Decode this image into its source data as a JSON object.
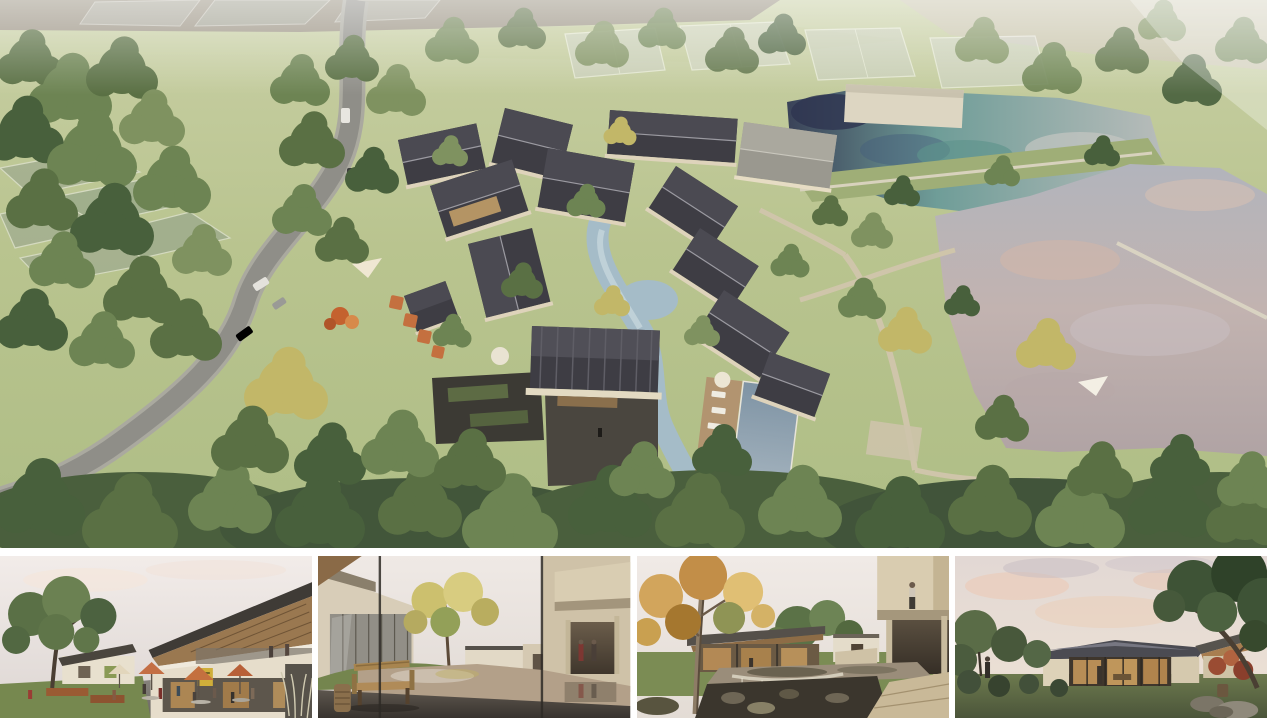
{
  "page": {
    "background": "#ffffff"
  },
  "panels": {
    "aerial": {
      "label": "Aerial rendering of a village resort masterplan: pitched-roof houses along a winding stream, curving road with cars on the left, dense woodland, lap pool with sun deck, and two reflective lakes on the right"
    },
    "street": {
      "label": "Street-level rendering of a retail lane with cafe seating, orange umbrellas, a large tree and a two-storey timber-roofed building"
    },
    "courtyard_pond": {
      "label": "Rendering of a courtyard reflecting pond seen through a window, with a wooden slat bench, yellow tree and beige buildings"
    },
    "autumn_courtyard": {
      "label": "Rendering of a garden courtyard with an autumn sycamore, stone weir pond and a cantilevered beige building with a person on the roof terrace"
    },
    "dusk_pavilion": {
      "label": "Dusk rendering of a single-storey glass pavilion with warm lit interior, framed by dark trees on a lawn"
    }
  },
  "palette": {
    "canvas": "#ffffff",
    "grass": "#b9c48f",
    "grass_light": "#c9d2a2",
    "forest": "#4e6440",
    "road": "#8f8e88",
    "road_shoulder": "#a8a79e",
    "stream": "#a5bcc8",
    "upper_lake_teal": "#6f9d98",
    "lower_lake": "#b6aeb4",
    "roof_dark": "#3e3d44",
    "roof_light": "#9a988f",
    "wall_beige": "#ded3bb",
    "path": "#cfc5aa",
    "pool": "#8496a9",
    "deck_wood": "#b29470",
    "court_stone": "#4a463f",
    "sky_pale": "#ece5e1",
    "sky_dusk": "#e4d9d4",
    "pond_tan": "#b3a089",
    "pond_stone": "#9a8d7a",
    "umbrella_orange": "#c4703f",
    "bench_wood": "#b08b58",
    "autumn": "#cda55c",
    "interior_warm": "#c89a5c",
    "ghost_volume": "#ced1cb"
  }
}
